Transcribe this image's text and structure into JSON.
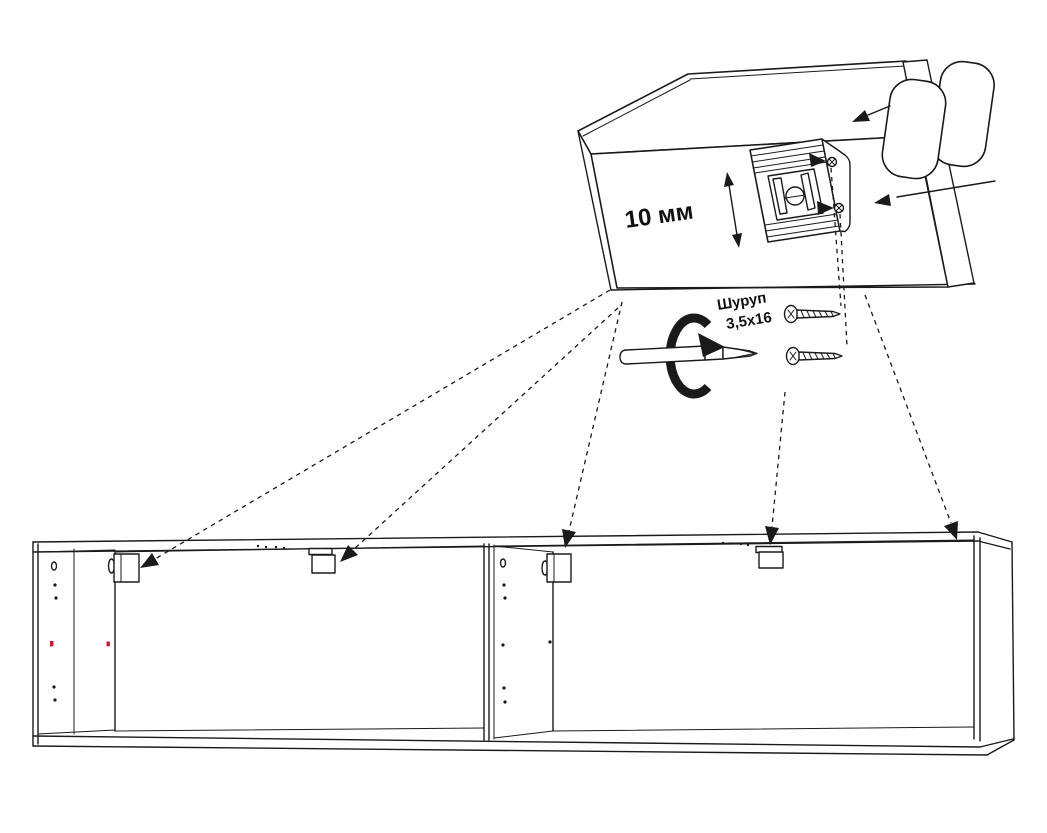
{
  "diagram": {
    "type": "furniture-assembly-instruction-step",
    "detail_view": {
      "adjustment_label": "10 мм",
      "flange_screw_count": 2
    },
    "hardware": {
      "screw_label_line1": "Шуруп",
      "screw_label_line2": "3,5x16",
      "screw_count": 2
    },
    "cabinet": {
      "modules": 2,
      "mounting_brackets": 4,
      "leader_arrows": 5,
      "red_hole_markers": 2
    },
    "colors": {
      "line": "#1a1a1a",
      "background": "#ffffff",
      "marker_red": "#c41a33"
    }
  }
}
